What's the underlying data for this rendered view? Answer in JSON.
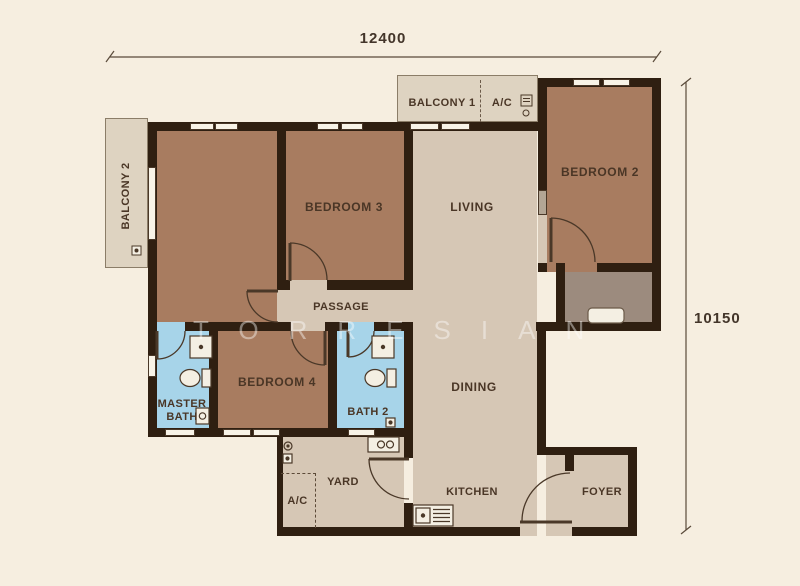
{
  "colors": {
    "background": "#f6eee0",
    "wall": "#2f1f11",
    "bedroom_floor": "#a87c60",
    "living_floor": "#d6c7b5",
    "bath_floor": "#a7d4e9",
    "balcony_floor": "#ded3c1",
    "shaft_floor": "#9c8b7e",
    "label_text": "#4a3626",
    "dimension_text": "#43352a",
    "watermark_color": "rgba(255,255,255,0.42)"
  },
  "dimensions": {
    "top": "12400",
    "right": "10150"
  },
  "watermark": "TORRESIAN",
  "rooms": {
    "balcony1": "BALCONY 1",
    "balcony2": "BALCONY 2",
    "ac_top": "A/C",
    "bedroom2": "BEDROOM 2",
    "bedroom3": "BEDROOM 3",
    "bedroom4": "BEDROOM 4",
    "living": "LIVING",
    "dining": "DINING",
    "kitchen": "KITCHEN",
    "foyer": "FOYER",
    "passage": "PASSAGE",
    "master_bath": "MASTER BATH",
    "bath2": "BATH 2",
    "yard": "YARD",
    "ac_yard": "A/C"
  }
}
